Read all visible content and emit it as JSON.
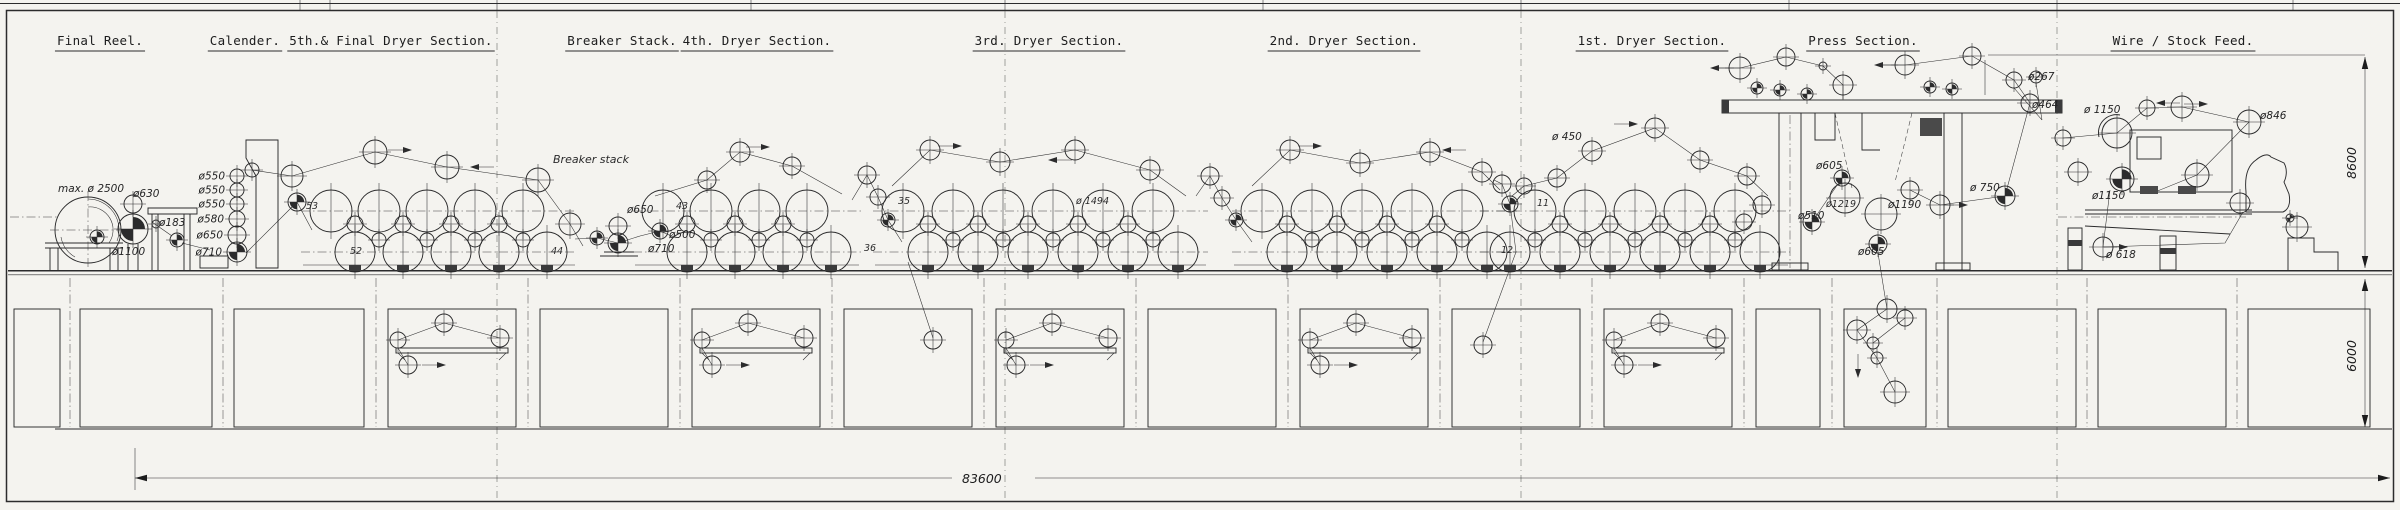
{
  "colors": {
    "ink": "#2b2b2c",
    "paper": "#f4f3ef"
  },
  "dimensions": {
    "overall_length": "83600",
    "machine_height": "8600",
    "basement_depth": "6000"
  },
  "sections": [
    {
      "label": "Final Reel.",
      "cx": 100
    },
    {
      "label": "Calender.",
      "cx": 245
    },
    {
      "label": "5th.& Final Dryer Section.",
      "cx": 391
    },
    {
      "label": "Breaker Stack.",
      "cx": 622
    },
    {
      "label": "4th. Dryer Section.",
      "cx": 757
    },
    {
      "label": "3rd. Dryer Section.",
      "cx": 1049
    },
    {
      "label": "2nd. Dryer Section.",
      "cx": 1344
    },
    {
      "label": "1st. Dryer Section.",
      "cx": 1652
    },
    {
      "label": "Press Section.",
      "cx": 1863
    },
    {
      "label": "Wire / Stock Feed.",
      "cx": 2183
    }
  ],
  "annotations": [
    [
      "max. ø 2500",
      58,
      192,
      "a"
    ],
    [
      "ø630",
      133,
      197,
      "a"
    ],
    [
      "ø183",
      159,
      226,
      "a"
    ],
    [
      "ø1100",
      112,
      255,
      "a"
    ],
    [
      "Breaker stack",
      553,
      163,
      "t"
    ],
    [
      "ø650",
      627,
      213,
      "a"
    ],
    [
      "ø500",
      669,
      238,
      "a"
    ],
    [
      "ø710",
      648,
      252,
      "a"
    ],
    [
      "53",
      306,
      209,
      "n"
    ],
    [
      "52",
      350,
      254,
      "n"
    ],
    [
      "44",
      551,
      254,
      "n"
    ],
    [
      "43",
      676,
      209,
      "n"
    ],
    [
      "36",
      864,
      251,
      "n"
    ],
    [
      "35",
      898,
      204,
      "n"
    ],
    [
      "ø 1494",
      1076,
      204,
      "n"
    ],
    [
      "ø 450",
      1552,
      140,
      "a"
    ],
    [
      "11",
      1537,
      206,
      "n"
    ],
    [
      "12",
      1501,
      253,
      "n"
    ],
    [
      "ø605",
      1816,
      169,
      "a"
    ],
    [
      "ø1219",
      1826,
      207,
      "n"
    ],
    [
      "ø1190",
      1888,
      208,
      "a"
    ],
    [
      "ø510",
      1798,
      219,
      "a"
    ],
    [
      "ø605",
      1858,
      255,
      "a"
    ],
    [
      "ø 750",
      1970,
      191,
      "a"
    ],
    [
      "ø267",
      2028,
      80,
      "a"
    ],
    [
      "ø464",
      2032,
      108,
      "a"
    ],
    [
      "ø 1150",
      2084,
      113,
      "a"
    ],
    [
      "ø846",
      2260,
      119,
      "a"
    ],
    [
      "ø1150",
      2092,
      199,
      "a"
    ],
    [
      "ø 618",
      2106,
      258,
      "a"
    ]
  ],
  "calender": {
    "x": 237,
    "rolls": [
      {
        "y": 176,
        "r": 7,
        "label": "ø550"
      },
      {
        "y": 190,
        "r": 7,
        "label": "ø550"
      },
      {
        "y": 204,
        "r": 7,
        "label": "ø550"
      },
      {
        "y": 219,
        "r": 8,
        "label": "ø580"
      },
      {
        "y": 235,
        "r": 9,
        "label": "ø650"
      },
      {
        "y": 252,
        "r": 10,
        "label": "ø710"
      }
    ]
  },
  "dryer": {
    "top_y": 211,
    "bot_y": 252,
    "r_top": 21,
    "r_bot": 20,
    "groups": [
      {
        "top": [
          331,
          379,
          427,
          475,
          523
        ],
        "bot": [
          355,
          403,
          451,
          499,
          547
        ]
      },
      {
        "top": [
          663,
          711,
          759,
          807
        ],
        "bot": [
          687,
          735,
          783,
          831
        ]
      },
      {
        "top": [
          903,
          953,
          1003,
          1053,
          1103,
          1153
        ],
        "bot": [
          928,
          978,
          1028,
          1078,
          1128,
          1178
        ]
      },
      {
        "top": [
          1262,
          1312,
          1362,
          1412,
          1462
        ],
        "bot": [
          1287,
          1337,
          1387,
          1437,
          1487
        ]
      },
      {
        "top": [
          1535,
          1585,
          1635,
          1685,
          1735
        ],
        "bot": [
          1510,
          1560,
          1610,
          1660,
          1710,
          1760
        ]
      }
    ]
  },
  "rolls": [
    [
      133,
      204,
      9,
      0
    ],
    [
      133,
      229,
      15,
      1
    ],
    [
      156,
      224,
      4,
      0
    ],
    [
      177,
      240,
      7,
      1
    ],
    [
      97,
      237,
      7,
      1
    ],
    [
      252,
      170,
      7,
      0
    ],
    [
      292,
      176,
      11,
      0
    ],
    [
      297,
      202,
      9,
      1
    ],
    [
      375,
      152,
      12,
      0
    ],
    [
      447,
      167,
      12,
      0
    ],
    [
      538,
      180,
      12,
      0
    ],
    [
      570,
      224,
      11,
      0
    ],
    [
      597,
      238,
      7,
      1
    ],
    [
      618,
      226,
      9,
      0
    ],
    [
      618,
      243,
      10,
      1
    ],
    [
      660,
      231,
      8,
      1
    ],
    [
      707,
      180,
      9,
      0
    ],
    [
      740,
      152,
      10,
      0
    ],
    [
      792,
      166,
      9,
      0
    ],
    [
      867,
      175,
      9,
      0
    ],
    [
      878,
      197,
      8,
      0
    ],
    [
      888,
      220,
      7,
      1
    ],
    [
      933,
      340,
      9,
      0
    ],
    [
      930,
      150,
      10,
      0
    ],
    [
      1000,
      162,
      10,
      0
    ],
    [
      1075,
      150,
      10,
      0
    ],
    [
      1150,
      170,
      10,
      0
    ],
    [
      1210,
      176,
      9,
      0
    ],
    [
      1222,
      198,
      8,
      0
    ],
    [
      1236,
      220,
      7,
      1
    ],
    [
      1290,
      150,
      10,
      0
    ],
    [
      1360,
      163,
      10,
      0
    ],
    [
      1430,
      152,
      10,
      0
    ],
    [
      1482,
      172,
      10,
      0
    ],
    [
      1502,
      184,
      9,
      0
    ],
    [
      1510,
      204,
      8,
      1
    ],
    [
      1483,
      345,
      9,
      0
    ],
    [
      1524,
      186,
      8,
      0
    ],
    [
      1557,
      178,
      9,
      0
    ],
    [
      1592,
      151,
      10,
      0
    ],
    [
      1655,
      128,
      10,
      0
    ],
    [
      1700,
      160,
      9,
      0
    ],
    [
      1747,
      176,
      9,
      0
    ],
    [
      1740,
      68,
      11,
      0
    ],
    [
      1786,
      57,
      9,
      0
    ],
    [
      1823,
      66,
      4,
      0
    ],
    [
      1843,
      85,
      10,
      0
    ],
    [
      1757,
      88,
      6,
      1
    ],
    [
      1780,
      90,
      6,
      1
    ],
    [
      1807,
      94,
      6,
      1
    ],
    [
      1905,
      65,
      10,
      0
    ],
    [
      1930,
      87,
      6,
      1
    ],
    [
      1952,
      89,
      6,
      1
    ],
    [
      1972,
      56,
      9,
      0
    ],
    [
      2014,
      80,
      8,
      0
    ],
    [
      2036,
      77,
      6,
      0
    ],
    [
      2030,
      103,
      9,
      0
    ],
    [
      1842,
      178,
      8,
      1
    ],
    [
      1845,
      198,
      15,
      0
    ],
    [
      1881,
      214,
      16,
      0
    ],
    [
      1812,
      222,
      9,
      1
    ],
    [
      1878,
      244,
      9,
      1
    ],
    [
      1910,
      190,
      9,
      0
    ],
    [
      1940,
      205,
      10,
      0
    ],
    [
      2005,
      196,
      10,
      1
    ],
    [
      1762,
      205,
      9,
      0
    ],
    [
      1744,
      222,
      8,
      0
    ],
    [
      1887,
      309,
      10,
      0
    ],
    [
      1857,
      330,
      10,
      0
    ],
    [
      1905,
      318,
      8,
      0
    ],
    [
      1873,
      343,
      6,
      0
    ],
    [
      1877,
      358,
      6,
      0
    ],
    [
      1895,
      392,
      11,
      0
    ],
    [
      2063,
      138,
      8,
      0
    ],
    [
      2078,
      172,
      10,
      0
    ],
    [
      2117,
      133,
      15,
      2
    ],
    [
      2147,
      108,
      8,
      0
    ],
    [
      2182,
      107,
      11,
      0
    ],
    [
      2249,
      122,
      12,
      0
    ],
    [
      2197,
      175,
      12,
      0
    ],
    [
      2122,
      179,
      12,
      1
    ],
    [
      2103,
      247,
      10,
      0
    ],
    [
      2240,
      203,
      10,
      0
    ],
    [
      2297,
      227,
      11,
      0
    ],
    [
      2290,
      218,
      4,
      1
    ]
  ],
  "felt_runs": [
    [
      [
        252,
        170
      ],
      [
        292,
        176
      ],
      [
        375,
        152
      ],
      [
        447,
        167
      ],
      [
        538,
        180
      ],
      [
        570,
        224
      ],
      [
        583,
        246
      ]
    ],
    [
      [
        246,
        253
      ],
      [
        297,
        202
      ],
      [
        312,
        230
      ]
    ],
    [
      [
        575,
        239
      ],
      [
        597,
        238
      ],
      [
        618,
        243
      ],
      [
        640,
        236
      ],
      [
        660,
        231
      ],
      [
        676,
        238
      ]
    ],
    [
      [
        655,
        196
      ],
      [
        707,
        180
      ],
      [
        740,
        152
      ],
      [
        792,
        166
      ],
      [
        842,
        194
      ]
    ],
    [
      [
        852,
        200
      ],
      [
        867,
        175
      ],
      [
        878,
        197
      ],
      [
        888,
        220
      ],
      [
        902,
        242
      ]
    ],
    [
      [
        908,
        262
      ],
      [
        933,
        338
      ]
    ],
    [
      [
        892,
        186
      ],
      [
        930,
        150
      ],
      [
        1000,
        162
      ],
      [
        1075,
        150
      ],
      [
        1150,
        170
      ],
      [
        1186,
        196
      ]
    ],
    [
      [
        1196,
        196
      ],
      [
        1210,
        176
      ],
      [
        1222,
        198
      ],
      [
        1236,
        220
      ],
      [
        1252,
        242
      ]
    ],
    [
      [
        1252,
        186
      ],
      [
        1290,
        150
      ],
      [
        1360,
        163
      ],
      [
        1430,
        152
      ],
      [
        1482,
        172
      ],
      [
        1500,
        190
      ]
    ],
    [
      [
        1494,
        180
      ],
      [
        1502,
        184
      ],
      [
        1510,
        204
      ],
      [
        1516,
        252
      ]
    ],
    [
      [
        1516,
        252
      ],
      [
        1483,
        342
      ]
    ],
    [
      [
        1512,
        196
      ],
      [
        1524,
        186
      ],
      [
        1557,
        178
      ],
      [
        1592,
        151
      ],
      [
        1655,
        128
      ],
      [
        1700,
        160
      ],
      [
        1747,
        176
      ],
      [
        1768,
        196
      ]
    ],
    [
      [
        1712,
        68
      ],
      [
        1740,
        68
      ],
      [
        1786,
        57
      ],
      [
        1823,
        66
      ],
      [
        1843,
        85
      ],
      [
        1843,
        100
      ]
    ],
    [
      [
        1876,
        65
      ],
      [
        1905,
        65
      ],
      [
        1972,
        56
      ],
      [
        2014,
        80
      ],
      [
        2030,
        103
      ]
    ],
    [
      [
        1842,
        178
      ],
      [
        1812,
        222
      ]
    ],
    [
      [
        1910,
        190
      ],
      [
        1940,
        205
      ],
      [
        2005,
        196
      ],
      [
        2030,
        103
      ]
    ],
    [
      [
        1878,
        253
      ],
      [
        1887,
        309
      ],
      [
        1857,
        330
      ],
      [
        1877,
        358
      ],
      [
        1895,
        392
      ]
    ],
    [
      [
        1905,
        318
      ],
      [
        1873,
        343
      ]
    ],
    [
      [
        2063,
        138
      ],
      [
        2117,
        133
      ],
      [
        2147,
        108
      ],
      [
        2182,
        107
      ],
      [
        2249,
        122
      ],
      [
        2197,
        175
      ],
      [
        2155,
        192
      ]
    ],
    [
      [
        2110,
        190
      ],
      [
        2103,
        247
      ],
      [
        2225,
        243
      ],
      [
        2243,
        212
      ]
    ]
  ],
  "arrows": [
    [
      412,
      150,
      "r"
    ],
    [
      470,
      167,
      "l"
    ],
    [
      770,
      147,
      "r"
    ],
    [
      962,
      146,
      "r"
    ],
    [
      1048,
      160,
      "l"
    ],
    [
      1322,
      146,
      "r"
    ],
    [
      1442,
      150,
      "l"
    ],
    [
      1638,
      124,
      "r"
    ],
    [
      1710,
      68,
      "l"
    ],
    [
      1874,
      65,
      "l"
    ],
    [
      1968,
      205,
      "r"
    ],
    [
      2128,
      247,
      "r"
    ],
    [
      2156,
      103,
      "l"
    ],
    [
      2208,
      104,
      "r"
    ],
    [
      1858,
      378,
      "d"
    ]
  ],
  "pits": [
    [
      14,
      46,
      0
    ],
    [
      80,
      132,
      0
    ],
    [
      234,
      130,
      0
    ],
    [
      388,
      128,
      1
    ],
    [
      540,
      128,
      0
    ],
    [
      692,
      128,
      1
    ],
    [
      844,
      128,
      0
    ],
    [
      996,
      128,
      1
    ],
    [
      1148,
      128,
      0
    ],
    [
      1300,
      128,
      1
    ],
    [
      1452,
      128,
      0
    ],
    [
      1604,
      128,
      1
    ],
    [
      1756,
      64,
      0
    ],
    [
      1844,
      82,
      0
    ],
    [
      1948,
      128,
      0
    ],
    [
      2098,
      128,
      0
    ],
    [
      2248,
      122,
      0
    ]
  ],
  "fold_lines": [
    497,
    1005,
    1521,
    2057
  ],
  "top_ticks": [
    300,
    330,
    497,
    751,
    1005,
    1263,
    1521,
    1789,
    2057,
    2293
  ]
}
